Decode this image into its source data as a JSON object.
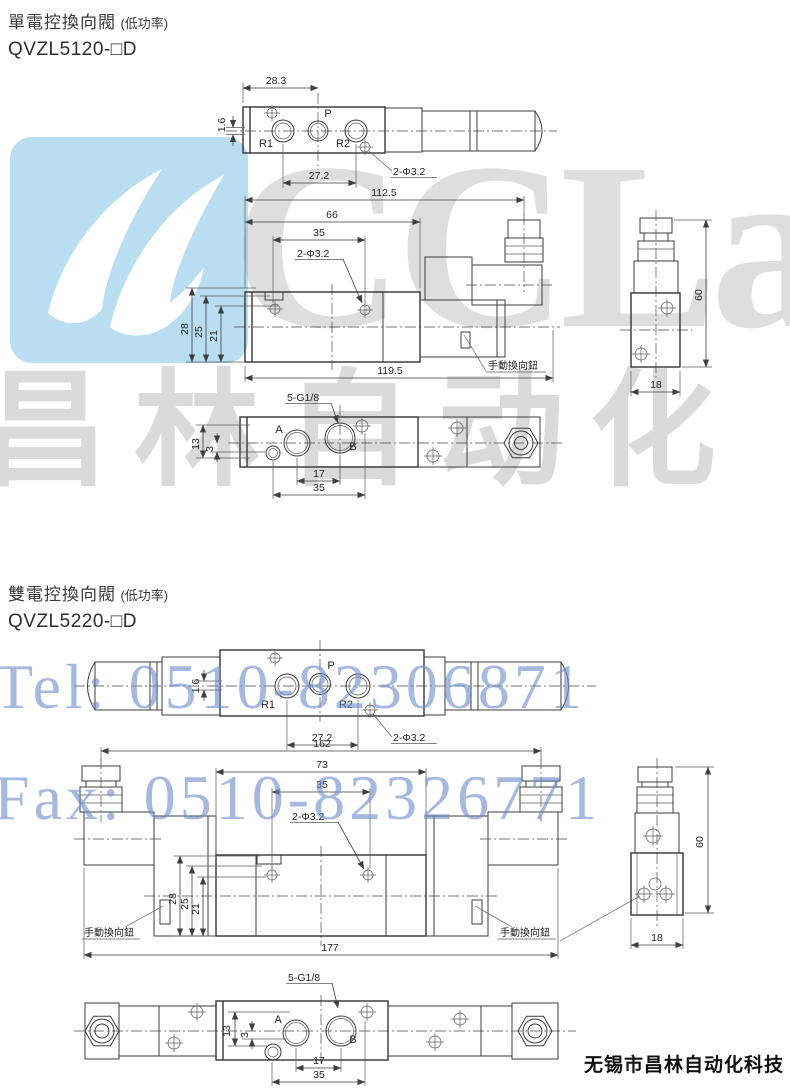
{
  "titles": {
    "s1_name": "單電控換向閥",
    "s1_power": "(低功率)",
    "s1_model": "QVZL5120-□D",
    "s2_name": "雙電控換向閥",
    "s2_power": "(低功率)",
    "s2_model": "QVZL5220-□D"
  },
  "watermarks": {
    "logo_text": "CCLair",
    "brand_cn": "昌林自动化",
    "tel": "Tel: 0510-82306871",
    "fax": "Fax: 0510-82326771",
    "logo_color": "#b9def2",
    "contact_color": "#6e8ccd"
  },
  "footer": {
    "company": "无锡市昌林自动化科技"
  },
  "s1": {
    "top": {
      "width_top": "28.3",
      "offset": "1.6",
      "port_r1": "R1",
      "port_p": "P",
      "port_r2": "R2",
      "pitch": "27.2",
      "holes": "2-Φ3.2"
    },
    "front": {
      "dim_total": "112.5",
      "dim_body": "66",
      "dim_inner": "35",
      "holes": "2-Φ3.2",
      "h28": "28",
      "h25": "25",
      "h21": "21",
      "overall": "119.5",
      "manual": "手動換向鈕"
    },
    "side": {
      "height": "60",
      "width": "18"
    },
    "bottom": {
      "thread": "5-G1/8",
      "port_a": "A",
      "port_b": "B",
      "v13": "13",
      "v3": "3",
      "w17": "17",
      "w35": "35"
    }
  },
  "s2": {
    "top": {
      "offset": "1.6",
      "port_r1": "R1",
      "port_p": "P",
      "port_r2": "R2",
      "pitch": "27.2",
      "holes": "2-Φ3.2"
    },
    "front": {
      "dim_total": "162",
      "dim_body": "73",
      "dim_inner": "35",
      "holes": "2-Φ3.2",
      "h28": "28",
      "h25": "25",
      "h21": "21",
      "overall": "177",
      "manual_left": "手動換向鈕",
      "manual_right": "手動換向鈕"
    },
    "side": {
      "height": "60",
      "width": "18"
    },
    "bottom": {
      "thread": "5-G1/8",
      "port_a": "A",
      "port_b": "B",
      "v13": "13",
      "v3": "3",
      "w17": "17",
      "w35": "35"
    }
  }
}
